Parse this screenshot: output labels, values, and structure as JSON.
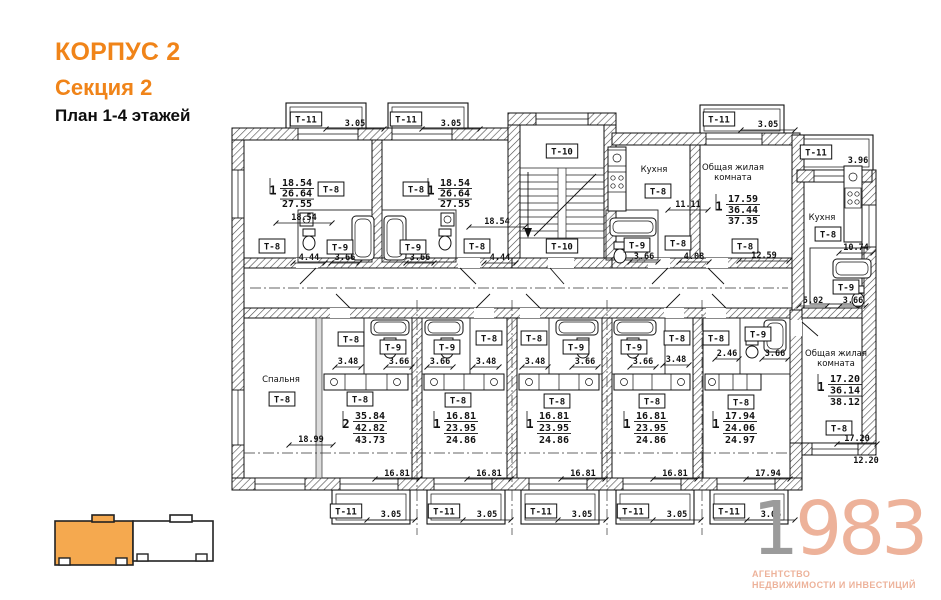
{
  "header": {
    "building": "КОРПУС 2",
    "section": "Секция 2",
    "plan_title": "План 1-4 этажей"
  },
  "colors": {
    "accent_orange": "#F08419",
    "logo_salmon": "#EDB29A",
    "logo_gray": "#9B9B9B",
    "minimap_highlight": "#F5A94F",
    "plan_ink": "#111111"
  },
  "logo": {
    "digit_gray": "1",
    "digits_salmon": "983",
    "tagline1": "АГЕНТСТВО",
    "tagline2": "НЕДВИЖИМОСТИ И ИНВЕСТИЦИЙ"
  },
  "plan": {
    "type_labels": [
      {
        "x": 306,
        "y": 119,
        "text": "Т-11"
      },
      {
        "x": 406,
        "y": 119,
        "text": "Т-11"
      },
      {
        "x": 719,
        "y": 119,
        "text": "Т-11"
      },
      {
        "x": 816,
        "y": 152,
        "text": "Т-11"
      },
      {
        "x": 346,
        "y": 511,
        "text": "Т-11"
      },
      {
        "x": 444,
        "y": 511,
        "text": "Т-11"
      },
      {
        "x": 541,
        "y": 511,
        "text": "Т-11"
      },
      {
        "x": 633,
        "y": 511,
        "text": "Т-11"
      },
      {
        "x": 729,
        "y": 511,
        "text": "Т-11"
      },
      {
        "x": 562,
        "y": 151,
        "text": "Т-10"
      },
      {
        "x": 562,
        "y": 246,
        "text": "Т-10"
      },
      {
        "x": 331,
        "y": 189,
        "text": "Т-8"
      },
      {
        "x": 416,
        "y": 189,
        "text": "Т-8"
      },
      {
        "x": 272,
        "y": 246,
        "text": "Т-8"
      },
      {
        "x": 340,
        "y": 247,
        "text": "Т-9"
      },
      {
        "x": 413,
        "y": 247,
        "text": "Т-9"
      },
      {
        "x": 477,
        "y": 246,
        "text": "Т-8"
      },
      {
        "x": 658,
        "y": 191,
        "text": "Т-8"
      },
      {
        "x": 637,
        "y": 245,
        "text": "Т-9"
      },
      {
        "x": 678,
        "y": 243,
        "text": "Т-8"
      },
      {
        "x": 745,
        "y": 246,
        "text": "Т-8"
      },
      {
        "x": 828,
        "y": 234,
        "text": "Т-8"
      },
      {
        "x": 846,
        "y": 287,
        "text": "Т-9"
      },
      {
        "x": 282,
        "y": 399,
        "text": "Т-8"
      },
      {
        "x": 351,
        "y": 339,
        "text": "Т-8"
      },
      {
        "x": 393,
        "y": 347,
        "text": "Т-9"
      },
      {
        "x": 360,
        "y": 399,
        "text": "Т-8"
      },
      {
        "x": 447,
        "y": 347,
        "text": "Т-9"
      },
      {
        "x": 489,
        "y": 338,
        "text": "Т-8"
      },
      {
        "x": 458,
        "y": 400,
        "text": "Т-8"
      },
      {
        "x": 534,
        "y": 338,
        "text": "Т-8"
      },
      {
        "x": 576,
        "y": 347,
        "text": "Т-9"
      },
      {
        "x": 557,
        "y": 401,
        "text": "Т-8"
      },
      {
        "x": 634,
        "y": 347,
        "text": "Т-9"
      },
      {
        "x": 677,
        "y": 338,
        "text": "Т-8"
      },
      {
        "x": 652,
        "y": 401,
        "text": "Т-8"
      },
      {
        "x": 716,
        "y": 338,
        "text": "Т-8"
      },
      {
        "x": 758,
        "y": 334,
        "text": "Т-9"
      },
      {
        "x": 741,
        "y": 402,
        "text": "Т-8"
      },
      {
        "x": 839,
        "y": 428,
        "text": "Т-8"
      }
    ],
    "room_names": [
      {
        "x": 654,
        "y": 172,
        "lines": [
          "Кухня"
        ]
      },
      {
        "x": 822,
        "y": 220,
        "lines": [
          "Кухня"
        ]
      },
      {
        "x": 733,
        "y": 170,
        "lines": [
          "Общая жилая",
          "комната"
        ]
      },
      {
        "x": 836,
        "y": 356,
        "lines": [
          "Общая жилая",
          "комната"
        ]
      },
      {
        "x": 281,
        "y": 382,
        "lines": [
          "Спальня"
        ]
      }
    ],
    "area_stacks": [
      {
        "x": 297,
        "y": 186,
        "dy": 10.5,
        "prefix": "1",
        "values": [
          "18.54",
          "26.64",
          "27.55"
        ]
      },
      {
        "x": 455,
        "y": 186,
        "dy": 10.5,
        "prefix": "1",
        "values": [
          "18.54",
          "26.64",
          "27.55"
        ]
      },
      {
        "x": 743,
        "y": 202,
        "dy": 11,
        "prefix": "1",
        "values": [
          "17.59",
          "36.44",
          "37.35"
        ]
      },
      {
        "x": 845,
        "y": 382,
        "dy": 11.5,
        "prefix": "1",
        "values": [
          "17.20",
          "36.14",
          "38.12"
        ]
      },
      {
        "x": 370,
        "y": 419,
        "dy": 12,
        "prefix": "2",
        "values": [
          "35.84",
          "42.82",
          "43.73"
        ]
      },
      {
        "x": 461,
        "y": 419,
        "dy": 12,
        "prefix": "1",
        "values": [
          "16.81",
          "23.95",
          "24.86"
        ]
      },
      {
        "x": 554,
        "y": 419,
        "dy": 12,
        "prefix": "1",
        "values": [
          "16.81",
          "23.95",
          "24.86"
        ]
      },
      {
        "x": 651,
        "y": 419,
        "dy": 12,
        "prefix": "1",
        "values": [
          "16.81",
          "23.95",
          "24.86"
        ]
      },
      {
        "x": 740,
        "y": 419,
        "dy": 12,
        "prefix": "1",
        "values": [
          "17.94",
          "24.06",
          "24.97"
        ]
      }
    ],
    "dims": [
      {
        "x": 355,
        "y": 126,
        "text": "3.05",
        "l": 58
      },
      {
        "x": 451,
        "y": 126,
        "text": "3.05",
        "l": 58
      },
      {
        "x": 768,
        "y": 127,
        "text": "3.05",
        "l": 54
      },
      {
        "x": 858,
        "y": 163,
        "text": "3.96",
        "l": 0
      },
      {
        "x": 304,
        "y": 220,
        "text": "18.54",
        "l": 56
      },
      {
        "x": 497,
        "y": 224,
        "text": "18.54",
        "l": 56
      },
      {
        "x": 309,
        "y": 260,
        "text": "4.44",
        "l": 32
      },
      {
        "x": 345,
        "y": 260,
        "text": "3.66",
        "l": 28
      },
      {
        "x": 420,
        "y": 260,
        "text": "3.66",
        "l": 28
      },
      {
        "x": 500,
        "y": 260,
        "text": "4.44",
        "l": 32
      },
      {
        "x": 688,
        "y": 207,
        "text": "11.11",
        "l": 40
      },
      {
        "x": 644,
        "y": 259,
        "text": "3.66",
        "l": 28
      },
      {
        "x": 694,
        "y": 259,
        "text": "4.08",
        "l": 30
      },
      {
        "x": 764,
        "y": 258,
        "text": "12.59",
        "l": 50
      },
      {
        "x": 856,
        "y": 250,
        "text": "10.74",
        "l": 34
      },
      {
        "x": 813,
        "y": 303,
        "text": "5.02",
        "l": 28
      },
      {
        "x": 853,
        "y": 303,
        "text": "3.66",
        "l": 26
      },
      {
        "x": 348,
        "y": 364,
        "text": "3.48",
        "l": 26
      },
      {
        "x": 399,
        "y": 364,
        "text": "3.66",
        "l": 26
      },
      {
        "x": 440,
        "y": 364,
        "text": "3.66",
        "l": 26
      },
      {
        "x": 486,
        "y": 364,
        "text": "3.48",
        "l": 26
      },
      {
        "x": 535,
        "y": 364,
        "text": "3.48",
        "l": 26
      },
      {
        "x": 585,
        "y": 364,
        "text": "3.66",
        "l": 26
      },
      {
        "x": 643,
        "y": 364,
        "text": "3.66",
        "l": 26
      },
      {
        "x": 676,
        "y": 362,
        "text": "3.48",
        "l": 26
      },
      {
        "x": 727,
        "y": 356,
        "text": "2.46",
        "l": 24
      },
      {
        "x": 775,
        "y": 356,
        "text": "3.66",
        "l": 26
      },
      {
        "x": 311,
        "y": 442,
        "text": "18.99",
        "l": 44
      },
      {
        "x": 397,
        "y": 476,
        "text": "16.81",
        "l": 44
      },
      {
        "x": 489,
        "y": 476,
        "text": "16.81",
        "l": 44
      },
      {
        "x": 583,
        "y": 476,
        "text": "16.81",
        "l": 44
      },
      {
        "x": 675,
        "y": 476,
        "text": "16.81",
        "l": 44
      },
      {
        "x": 768,
        "y": 476,
        "text": "17.94",
        "l": 44
      },
      {
        "x": 857,
        "y": 441,
        "text": "17.20",
        "l": 40
      },
      {
        "x": 866,
        "y": 463,
        "text": "12.20",
        "l": 0
      },
      {
        "x": 391,
        "y": 517,
        "text": "3.05",
        "l": 48
      },
      {
        "x": 487,
        "y": 517,
        "text": "3.05",
        "l": 48
      },
      {
        "x": 582,
        "y": 517,
        "text": "3.05",
        "l": 48
      },
      {
        "x": 677,
        "y": 517,
        "text": "3.05",
        "l": 48
      },
      {
        "x": 771,
        "y": 517,
        "text": "3.05",
        "l": 48
      }
    ]
  }
}
